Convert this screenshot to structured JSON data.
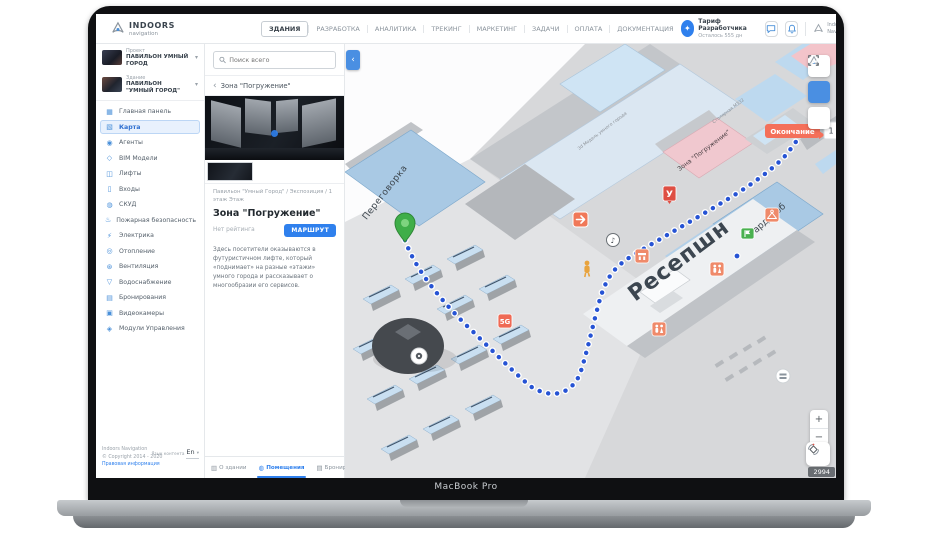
{
  "laptop": {
    "brand": "MacBook Pro"
  },
  "header": {
    "logo_title": "INDOORS",
    "logo_subtitle": "navigation",
    "nav_items": [
      "ЗДАНИЯ",
      "РАЗРАБОТКА",
      "АНАЛИТИКА",
      "ТРЕКИНГ",
      "МАРКЕТИНГ",
      "ЗАДАЧИ",
      "ОПЛАТА",
      "ДОКУМЕНТАЦИЯ"
    ],
    "tariff_title": "Тариф Разработчика",
    "tariff_subtitle": "Осталось 555 дн",
    "account_line1": "Indoors",
    "account_line2": "Navigation"
  },
  "sidebar": {
    "project_label": "Проект",
    "project_name": "ПАВИЛЬОН УМНЫЙ ГОРОД",
    "building_label": "Здание",
    "building_name": "ПАВИЛЬОН \"УМНЫЙ ГОРОД\"",
    "items": [
      {
        "label": "Главная панель"
      },
      {
        "label": "Карта"
      },
      {
        "label": "Агенты"
      },
      {
        "label": "BIM Модели"
      },
      {
        "label": "Лифты"
      },
      {
        "label": "Входы"
      },
      {
        "label": "СКУД"
      },
      {
        "label": "Пожарная безопасность"
      },
      {
        "label": "Электрика"
      },
      {
        "label": "Отопление"
      },
      {
        "label": "Вентиляция"
      },
      {
        "label": "Водоснабжение"
      },
      {
        "label": "Бронирования"
      },
      {
        "label": "Видеокамеры"
      },
      {
        "label": "Модули Управления"
      }
    ],
    "footer_company": "Indoors Navigation",
    "footer_copyright": "© Copyright 2014 - 2020",
    "footer_legal": "Правовая информация",
    "footer_lang_label": "Язык контента",
    "footer_lang_value": "En"
  },
  "panel": {
    "search_placeholder": "Поиск всего",
    "back_title": "Зона \"Погружение\"",
    "breadcrumb": "Павильон \"Умный Город\" / Экспозиция / 1 этаж Этаж",
    "title": "Зона \"Погружение\"",
    "rating": "Нет рейтинга",
    "route_button": "МАРШРУТ",
    "description": "Здесь посетители оказываются в футуристичном лифте, который «поднимает» на разные «этажи» умного города и рассказывает о многообразии его сервисов.",
    "tabs": [
      {
        "label": "О здании"
      },
      {
        "label": "Помещения"
      },
      {
        "label": "Бронирование"
      }
    ]
  },
  "map": {
    "labels": {
      "meeting_room": "Переговорка",
      "reception": "Ресепшн",
      "wardrobe": "Гардероб",
      "immersion_zone": "Зона \"Погружение\"",
      "server_room": "Столярная МЗ32",
      "corridor_3d": "3d Модель умного города"
    },
    "finish_label": "Окончание",
    "finish_count": "1",
    "badge_u": "У",
    "badge_5g": "5G",
    "counter": "2994",
    "colors": {
      "accent": "#2f80ed",
      "route": "#2653d4",
      "finish": "#f4705a",
      "poi": "#ef8a6a",
      "start": "#3fae49"
    }
  }
}
